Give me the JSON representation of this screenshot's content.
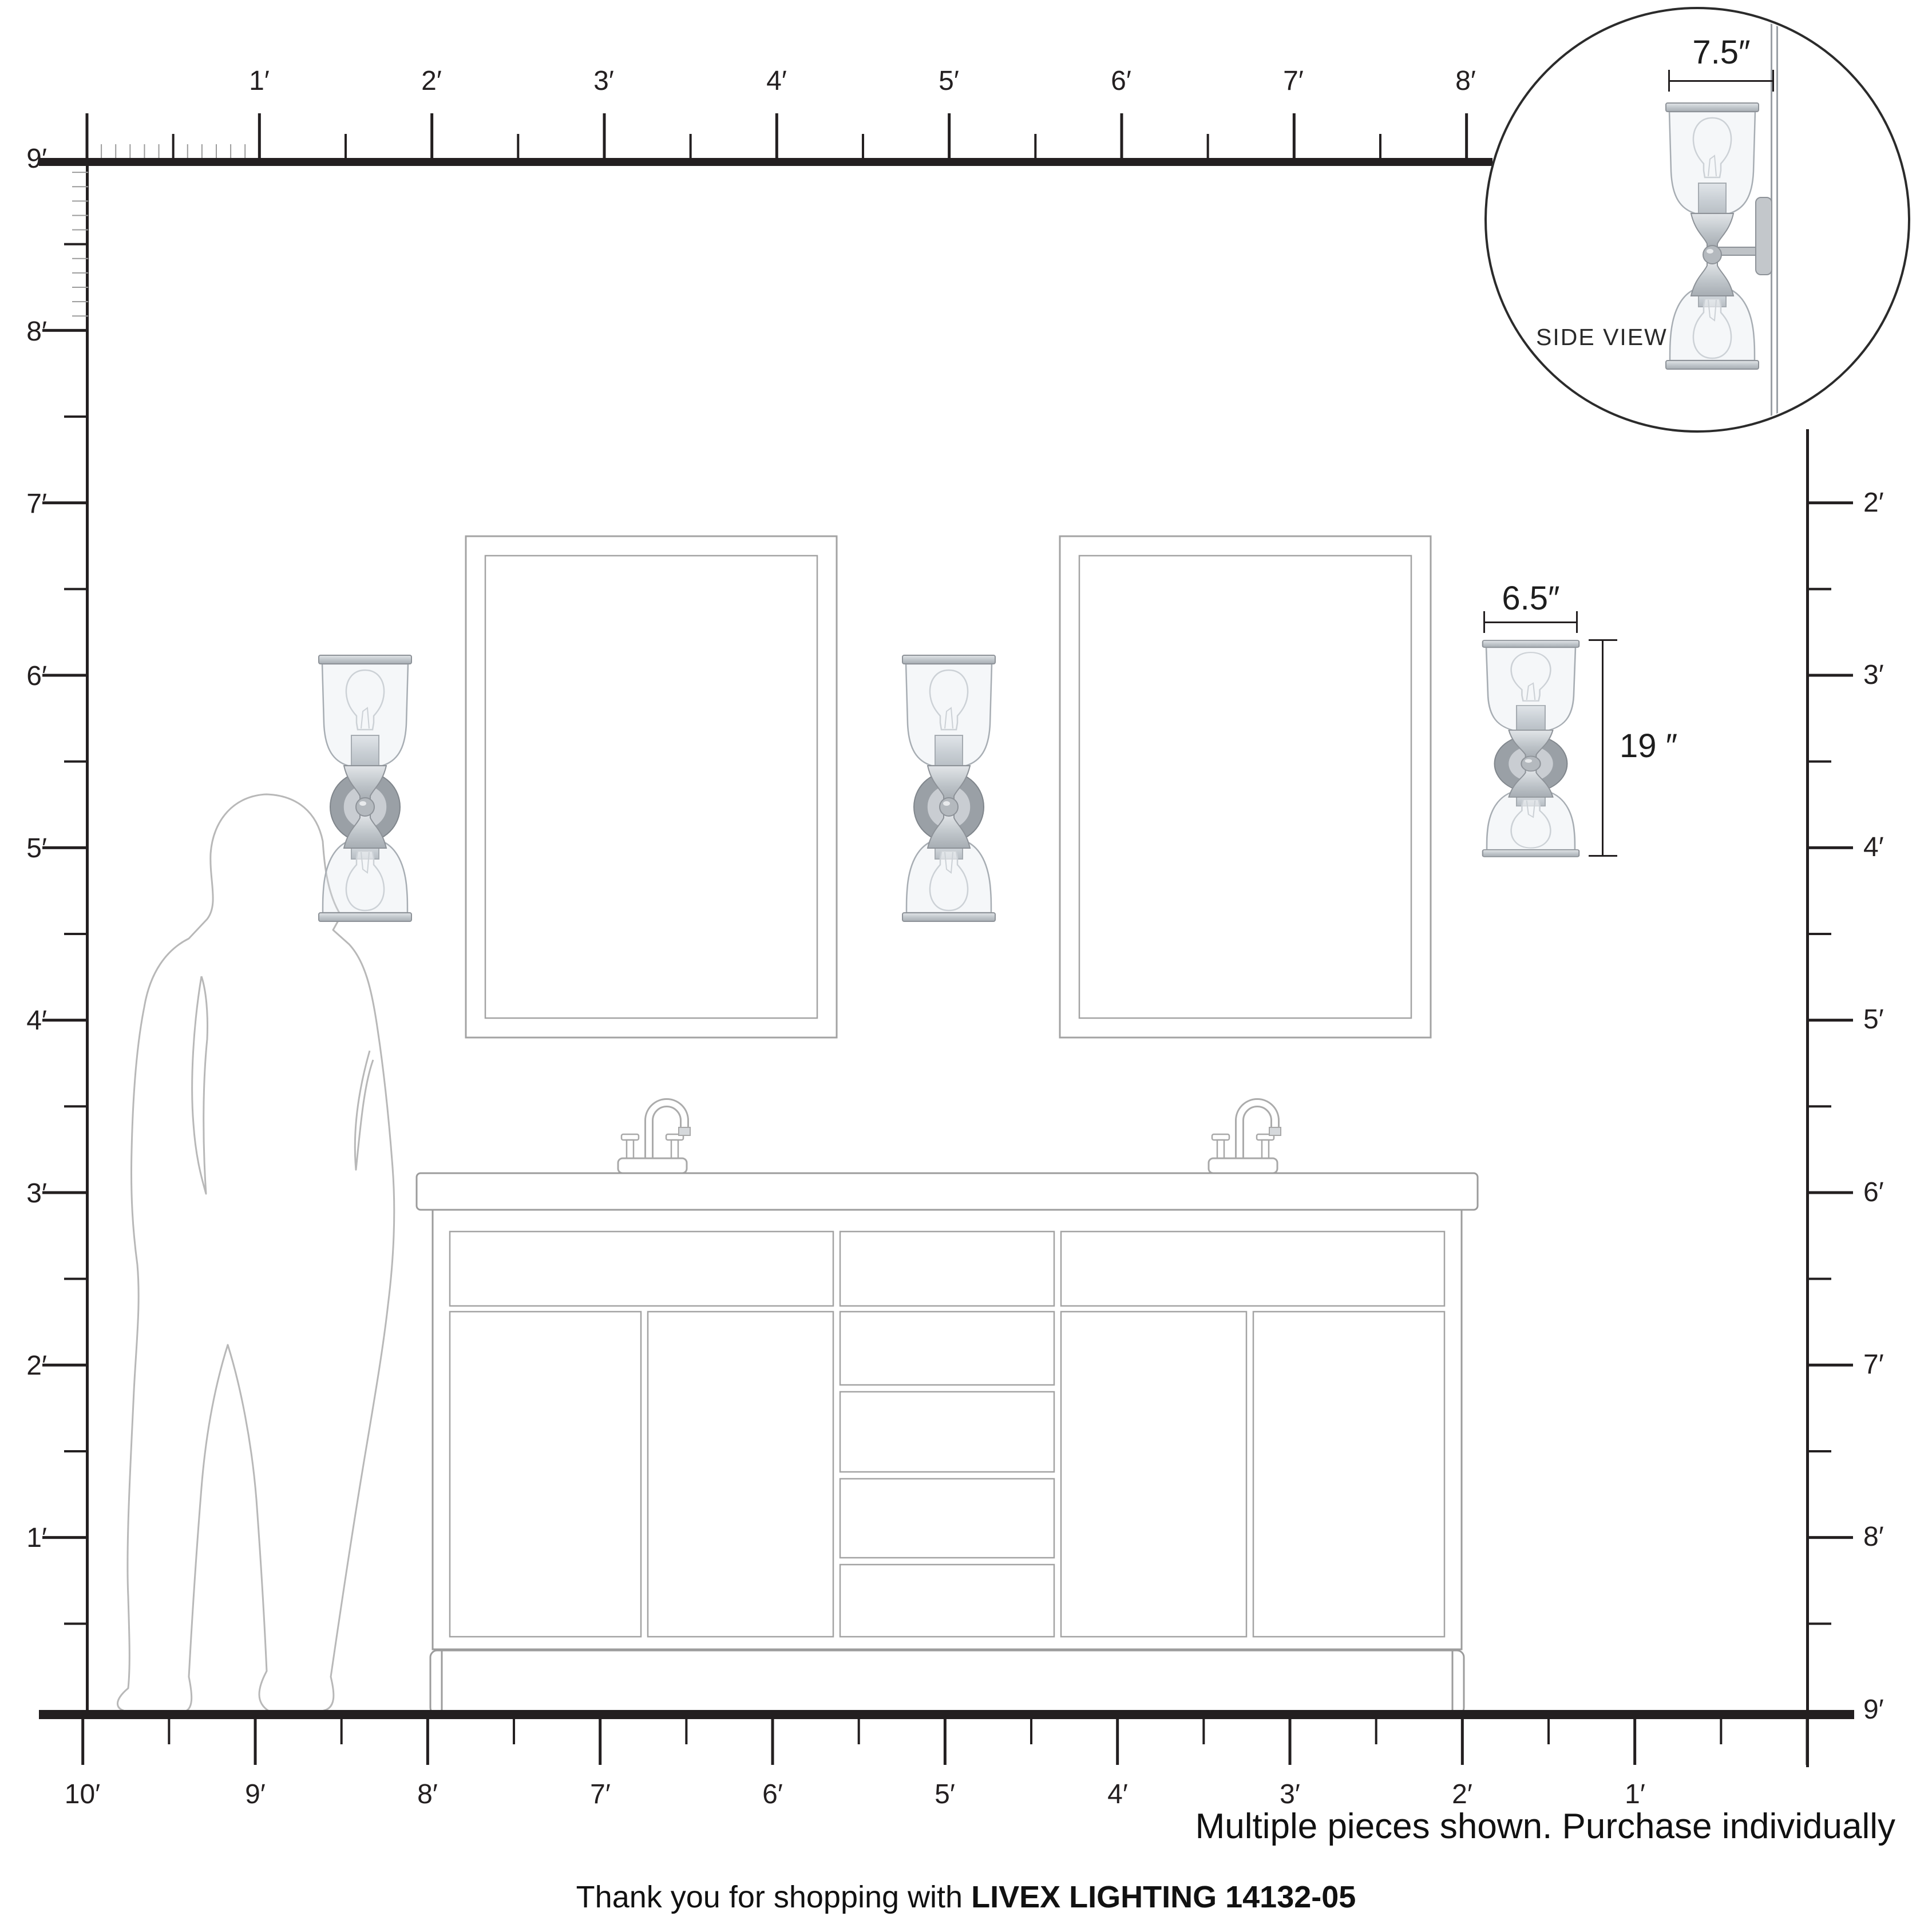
{
  "note": "Multiple pieces shown. Purchase individually",
  "footer": {
    "prefix": "Thank you for shopping with ",
    "brand": "LIVEX LIGHTING 14132-05"
  },
  "inset": {
    "label": "SIDE VIEW",
    "depth_label": "7.5″"
  },
  "fixture_dimensions": {
    "width_label": "6.5″",
    "height_label": "19 ″"
  },
  "rulers": {
    "top": [
      "1′",
      "2′",
      "3′",
      "4′",
      "5′",
      "6′",
      "7′",
      "8′"
    ],
    "left": [
      "9′",
      "8′",
      "7′",
      "6′",
      "5′",
      "4′",
      "3′",
      "2′",
      "1′"
    ],
    "right": [
      "2′",
      "3′",
      "4′",
      "5′",
      "6′",
      "7′",
      "8′",
      "9′"
    ],
    "bottom": [
      "10′",
      "9′",
      "8′",
      "7′",
      "6′",
      "5′",
      "4′",
      "3′",
      "2′",
      "1′"
    ]
  },
  "colors": {
    "ink": "#231f20",
    "furniture_line": "#9c9c9c",
    "silhouette_line": "#b8b8b8",
    "metal_fill": "#c3c8cd",
    "metal_dark": "#9aa0a6"
  }
}
